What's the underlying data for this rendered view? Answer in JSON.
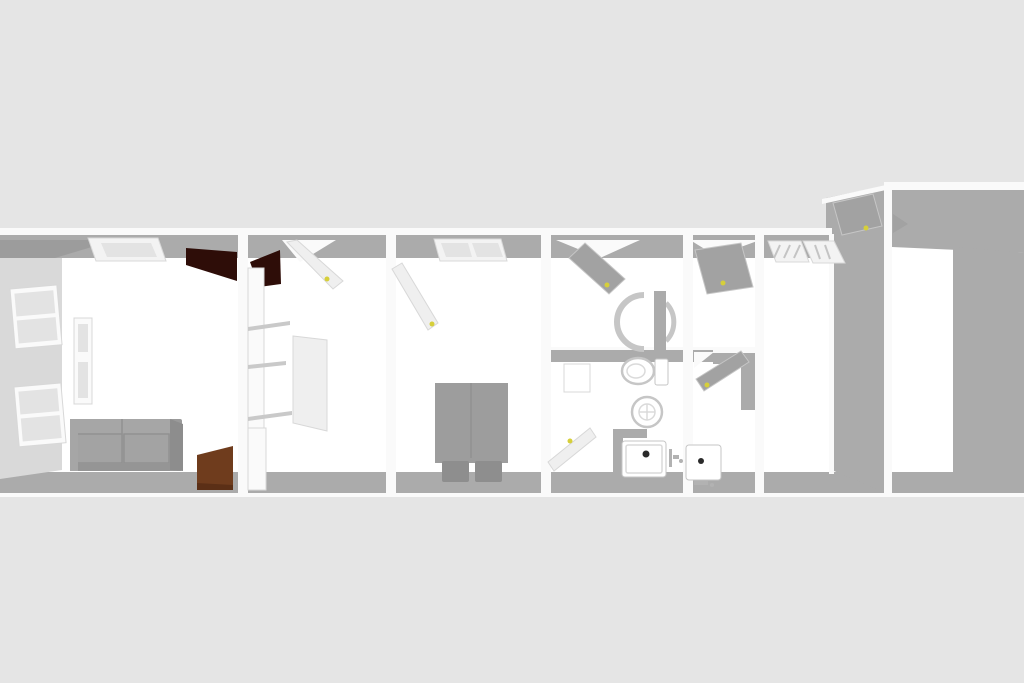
{
  "scene": {
    "type": "3d-floorplan-render",
    "view": "top-down-perspective",
    "visible_text": ""
  },
  "colors": {
    "background": "#e5e5e5",
    "floor": "#ffffff",
    "wall_face": "#ababab",
    "wall_face_dark": "#9c9c9c",
    "wall_face_light": "#d9d9d9",
    "wall_cap": "#fafafa",
    "ceiling_panel": "#f3f3f3",
    "panel_pane": "#e3e3e3",
    "shelf_edge": "#c9c9c9",
    "sofa_body": "#9a9a9a",
    "sofa_back": "#a6a6a6",
    "sofa_cushion": "#a3a3a3",
    "sofa_side": "#8d8d8d",
    "sofa_front": "#959595",
    "bed_mattress": "#9d9d9d",
    "bed_pillow": "#8e8e8e",
    "door_white": "#efefef",
    "door_gray": "#a2a2a2",
    "door_dark_brown": "#2e0d08",
    "door_brown": "#6f3c1d",
    "door_brown_dark": "#5b2f16",
    "handle_yellow": "#d6cf3a",
    "fixture_white": "#ffffff",
    "fixture_outline": "#c6c6c6",
    "fixture_metal": "#b2b2b2",
    "drain_black": "#2a2a2a"
  },
  "objects": {
    "furniture": [
      "sofa",
      "radiator",
      "shelf-unit",
      "double-bed"
    ],
    "fixtures": [
      "toilet",
      "round-washbasin",
      "sink-cabinet",
      "round-shower",
      "shower-tray-1",
      "shower-tray-2"
    ],
    "openings": [
      "window-1",
      "window-2",
      "ceiling-light",
      "ceiling-vent",
      "slatted-panel-1",
      "slatted-panel-2"
    ],
    "doors": [
      "dark-double-door",
      "brown-door",
      "white-door-room2",
      "white-panel-door",
      "white-door-bedroom",
      "gray-door-bath1",
      "white-door-bath1",
      "gray-door-bath2-top",
      "gray-door-bath2-mid",
      "gray-door-entry",
      "small-gray-door"
    ]
  }
}
